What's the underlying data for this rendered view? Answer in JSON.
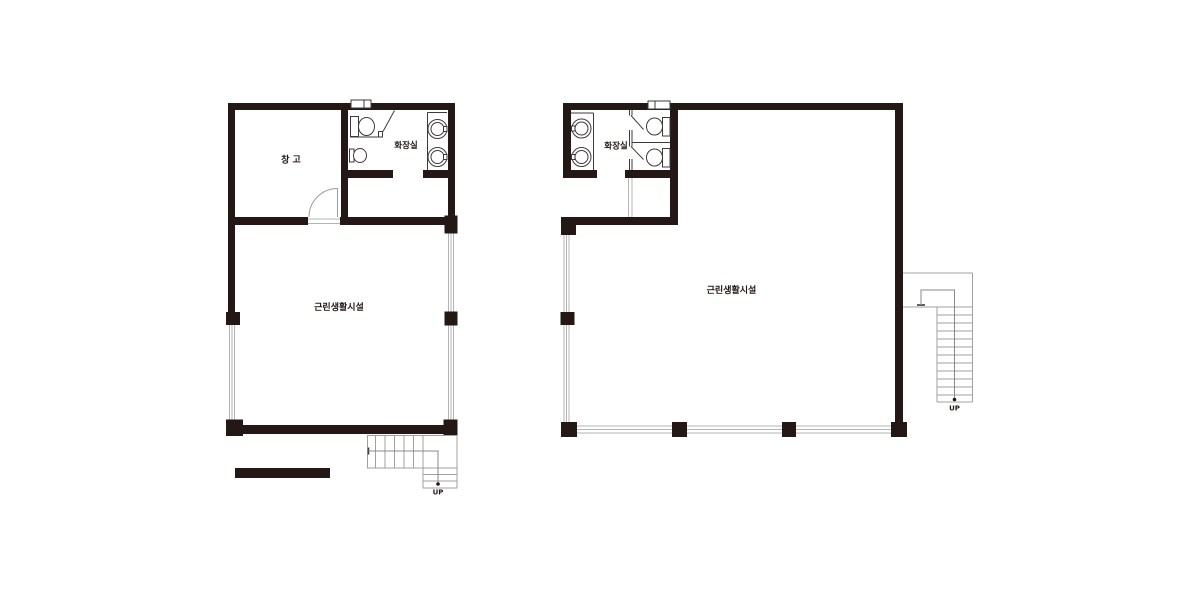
{
  "canvas": {
    "width": 1200,
    "height": 600,
    "background": "#ffffff"
  },
  "colors": {
    "wall": "#231815",
    "fixture_line": "#3f3a39",
    "window_line": "#b4b4b5",
    "stair_line": "#9fa0a0",
    "text": "#231815"
  },
  "symbols": [
    "toilet-symbol",
    "wash-basin-symbol",
    "hand-sink-symbol",
    "door-swing-symbol",
    "window-symbol",
    "stair-symbol",
    "direction-arrow-symbol"
  ],
  "plans": {
    "first_floor": {
      "labels": {
        "storage": "창 고",
        "restroom": "화장실",
        "main_room": "근린생활시설",
        "stairs_up": "UP"
      }
    },
    "second_floor": {
      "labels": {
        "restroom": "화장실",
        "main_room": "근린생활시설",
        "stairs_up": "UP"
      }
    }
  }
}
